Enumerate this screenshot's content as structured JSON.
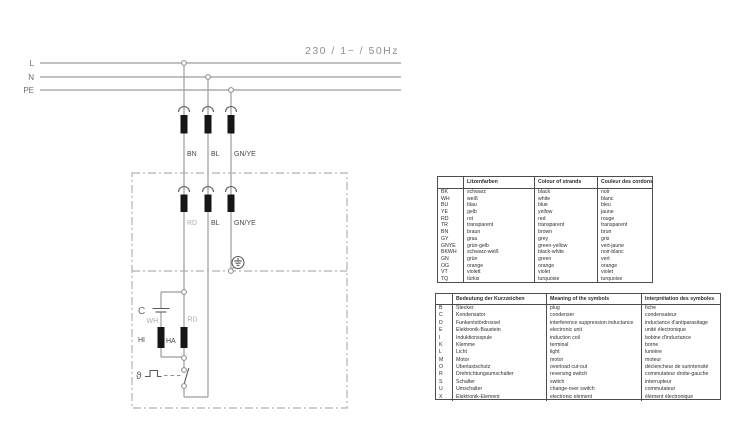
{
  "title": "230 / 1~ / 50Hz",
  "palette": {
    "wire_grey": "#9c9c9c",
    "ink": "#2e2e2e",
    "boundary_grey": "#b0b0b0"
  },
  "diagram": {
    "supply_labels": {
      "l": "L",
      "n": "N",
      "pe": "PE"
    },
    "cord_labels": [
      "BN",
      "BL",
      "GN/YE"
    ],
    "inner_labels": [
      "RD",
      "BL",
      "GN/YE"
    ],
    "component_labels": {
      "capacitor": "C",
      "cap_wire": "WH",
      "heater_wire": "RD",
      "heater_left": "HI",
      "heater_right": "HA",
      "thermal": "ϑ"
    }
  },
  "tables": {
    "colors": {
      "headers": [
        "",
        "Litzenfarben",
        "Colour of strands",
        "Couleur des cordons"
      ],
      "rows": [
        {
          "code": "BK",
          "de": "schwarz",
          "en": "black",
          "fr": "noir"
        },
        {
          "code": "WH",
          "de": "weiß",
          "en": "white",
          "fr": "blanc"
        },
        {
          "code": "BU",
          "de": "blau",
          "en": "blue",
          "fr": "bleu"
        },
        {
          "code": "YE",
          "de": "gelb",
          "en": "yellow",
          "fr": "jaune"
        },
        {
          "code": "RD",
          "de": "rot",
          "en": "red",
          "fr": "rouge"
        },
        {
          "code": "TR",
          "de": "transparent",
          "en": "transparent",
          "fr": "transparent"
        },
        {
          "code": "BN",
          "de": "braun",
          "en": "brown",
          "fr": "brun"
        },
        {
          "code": "GY",
          "de": "grau",
          "en": "grey",
          "fr": "gris"
        },
        {
          "code": "GNYE",
          "de": "grün-gelb",
          "en": "green-yellow",
          "fr": "vert-jaune"
        },
        {
          "code": "BKWH",
          "de": "schwarz-weiß",
          "en": "black-white",
          "fr": "noir-blanc"
        },
        {
          "code": "GN",
          "de": "grün",
          "en": "green",
          "fr": "vert"
        },
        {
          "code": "OG",
          "de": "orange",
          "en": "orange",
          "fr": "orange"
        },
        {
          "code": "VT",
          "de": "violett",
          "en": "violet",
          "fr": "violet"
        },
        {
          "code": "TQ",
          "de": "türkis",
          "en": "turquoise",
          "fr": "turquoise"
        }
      ]
    },
    "symbols": {
      "headers": [
        "",
        "Bedeutung der Kurzzeichen",
        "Meaning of the symbols",
        "Interprétation des symboles"
      ],
      "rows": [
        {
          "code": "B",
          "de": "Stecker",
          "en": "plug",
          "fr": "fiche"
        },
        {
          "code": "C",
          "de": "Kondensator",
          "en": "condenser",
          "fr": "condensateur"
        },
        {
          "code": "D",
          "de": "Funkentstördrossel",
          "en": "interference suppression inductance",
          "fr": "inductance d'antiparasitage"
        },
        {
          "code": "E",
          "de": "Elektronik-Baustein",
          "en": "electronic unit",
          "fr": "unité électronique"
        },
        {
          "code": "I",
          "de": "Induktionsspule",
          "en": "induction coil",
          "fr": "bobine d'inductance"
        },
        {
          "code": "K",
          "de": "Klemme",
          "en": "terminal",
          "fr": "borne"
        },
        {
          "code": "L",
          "de": "Licht",
          "en": "light",
          "fr": "lumière"
        },
        {
          "code": "M",
          "de": "Motor",
          "en": "motor",
          "fr": "moteur"
        },
        {
          "code": "O",
          "de": "Überlastschutz",
          "en": "overload cut-out",
          "fr": "déclencheur de surintensité"
        },
        {
          "code": "R",
          "de": "Drehrichtungsumschalter",
          "en": "reversing switch",
          "fr": "commutateur droite-gauche"
        },
        {
          "code": "S",
          "de": "Schalter",
          "en": "switch",
          "fr": "interrupteur"
        },
        {
          "code": "U",
          "de": "Umschalter",
          "en": "change-over switch",
          "fr": "commutateur"
        },
        {
          "code": "X",
          "de": "Elektronik-Element",
          "en": "electronic element",
          "fr": "élément électronique"
        }
      ]
    }
  }
}
